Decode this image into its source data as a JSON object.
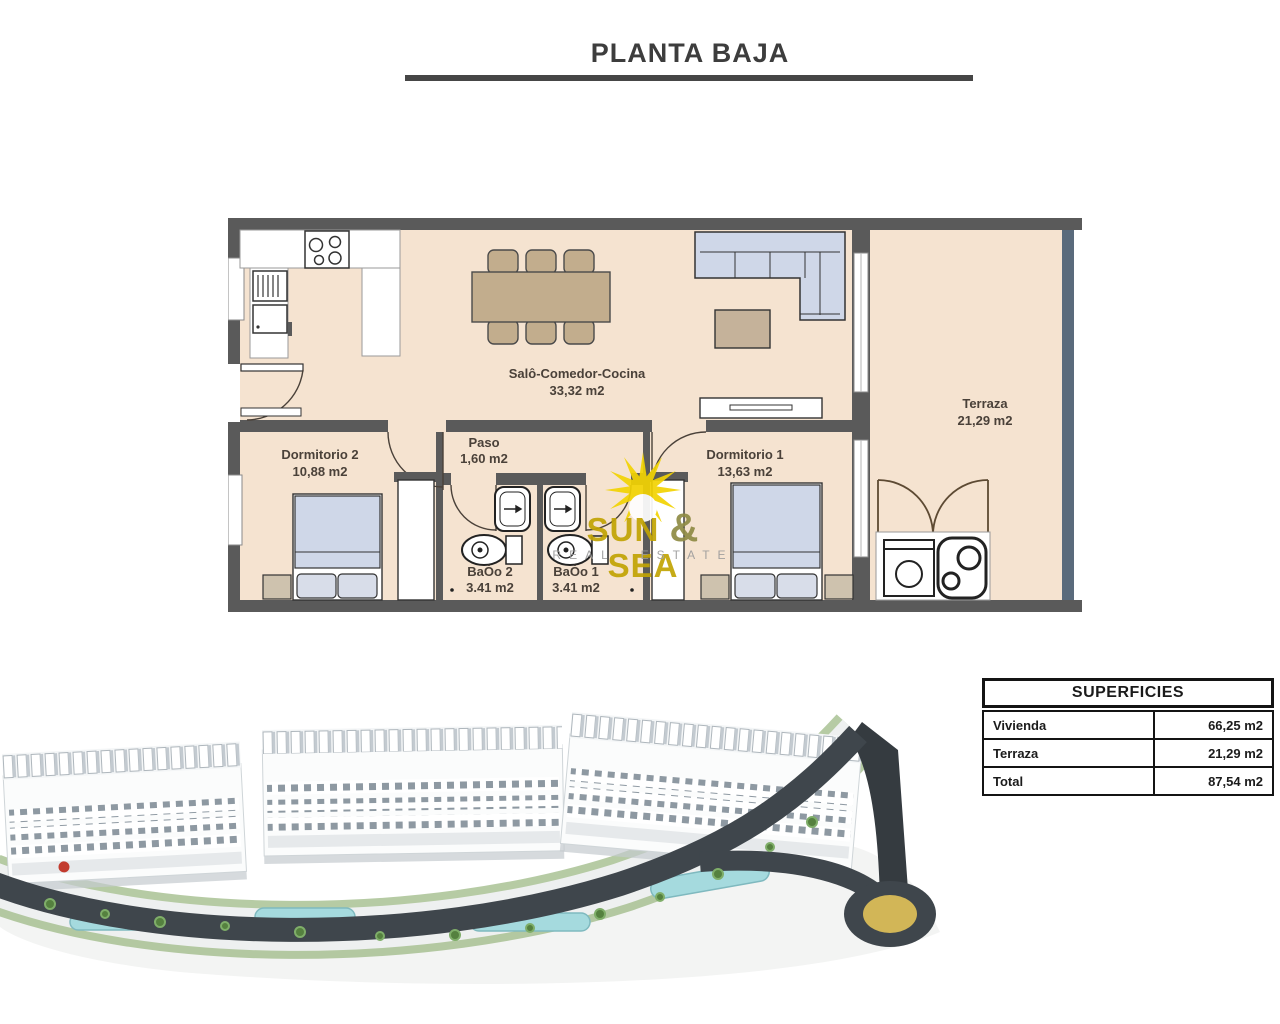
{
  "page": {
    "title": "PLANTA BAJA"
  },
  "floor_plan": {
    "rooms": {
      "salon": {
        "name": "Salô-Comedor-Cocina",
        "area": "33,32 m2"
      },
      "paso": {
        "name": "Paso",
        "area": "1,60 m2"
      },
      "dormitorio2": {
        "name": "Dormitorio 2",
        "area": "10,88 m2"
      },
      "dormitorio1": {
        "name": "Dormitorio 1",
        "area": "13,63 m2"
      },
      "bano2": {
        "name": "BaȮo 2",
        "area": "3.41 m2"
      },
      "bano1": {
        "name": "BaȮo 1",
        "area": "3.41 m2"
      },
      "terraza": {
        "name": "Terraza",
        "area": "21,29 m2"
      }
    }
  },
  "watermark": {
    "word1": "SUN",
    "ampersand": "&",
    "word2": "SEA",
    "subtitle": "REAL ESTATE"
  },
  "superficies": {
    "title": "SUPERFICIES",
    "rows": [
      {
        "label": "Vivienda",
        "value": "66,25 m2"
      },
      {
        "label": "Terraza",
        "value": "21,29 m2"
      },
      {
        "label": "Total",
        "value": "87,54 m2"
      }
    ]
  },
  "colors": {
    "wall": "#5a5a5a",
    "floor": "#f5e3d0",
    "terrace_wall": "#5a6b7c",
    "furniture_blue": "#cfd7e8",
    "furniture_tan": "#c2ad8d",
    "sun_yellow": "#f2d303",
    "logo_gold": "#c2a404",
    "logo_gray": "#9b9b9b",
    "road": "#3f464c",
    "pool": "#a5dade",
    "grass": "#94b37f",
    "roundabout_gold": "#d2b657",
    "building_white": "#fbfcfc",
    "flag_red": "#c23b2e"
  }
}
